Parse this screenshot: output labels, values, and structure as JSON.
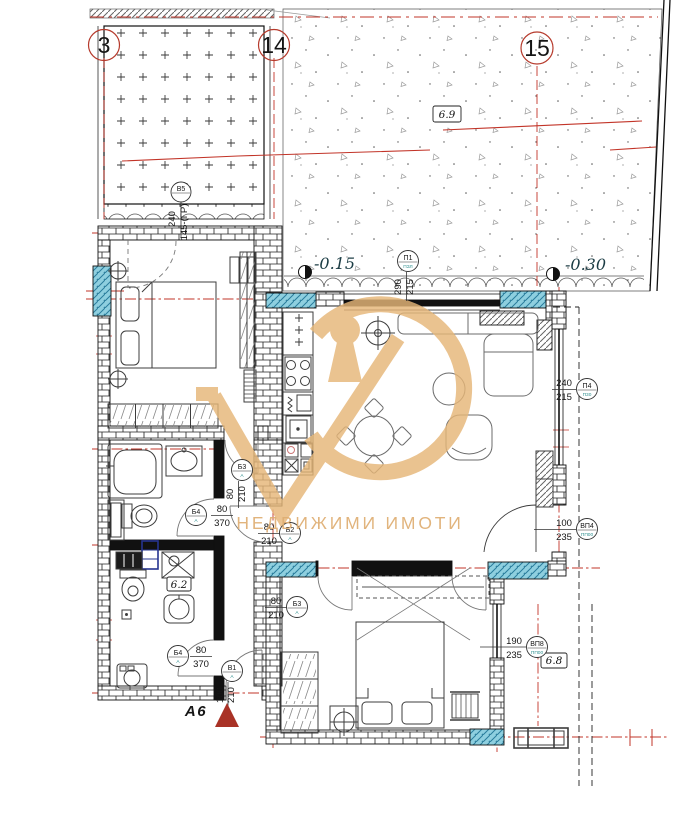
{
  "watermark": "НЕДВИЖИМИ ИМОТИ",
  "apartment": "А6",
  "grid": [
    "3",
    "14",
    "15"
  ],
  "levels": [
    "-0.15",
    "-0.30"
  ],
  "areas": [
    "6.9",
    "6.2",
    "6.8"
  ],
  "tags": [
    {
      "c": "П1",
      "s": "ПЗЛ",
      "a": "290",
      "b": "215"
    },
    {
      "c": "В5",
      "s": "",
      "a": "240",
      "b": "145-(ГР)"
    },
    {
      "c": "П4",
      "s": "П30",
      "a": "240",
      "b": "215"
    },
    {
      "c": "ВП4",
      "s": "ПП00",
      "a": "100",
      "b": "235"
    },
    {
      "c": "ВП8",
      "s": "ПП00",
      "a": "190",
      "b": "235"
    },
    {
      "c": "Б3",
      "s": "А",
      "a": "80",
      "b": "210"
    },
    {
      "c": "Б4",
      "s": "А",
      "a": "80",
      "b": "370"
    },
    {
      "c": "Б4",
      "s": "А",
      "a": "80",
      "b": "370"
    },
    {
      "c": "В1",
      "s": "А",
      "a": "100",
      "b": "210"
    },
    {
      "c": "Б2",
      "s": "А",
      "a": "80",
      "b": "210"
    },
    {
      "c": "Б3",
      "s": "А",
      "a": "80",
      "b": "210"
    }
  ]
}
